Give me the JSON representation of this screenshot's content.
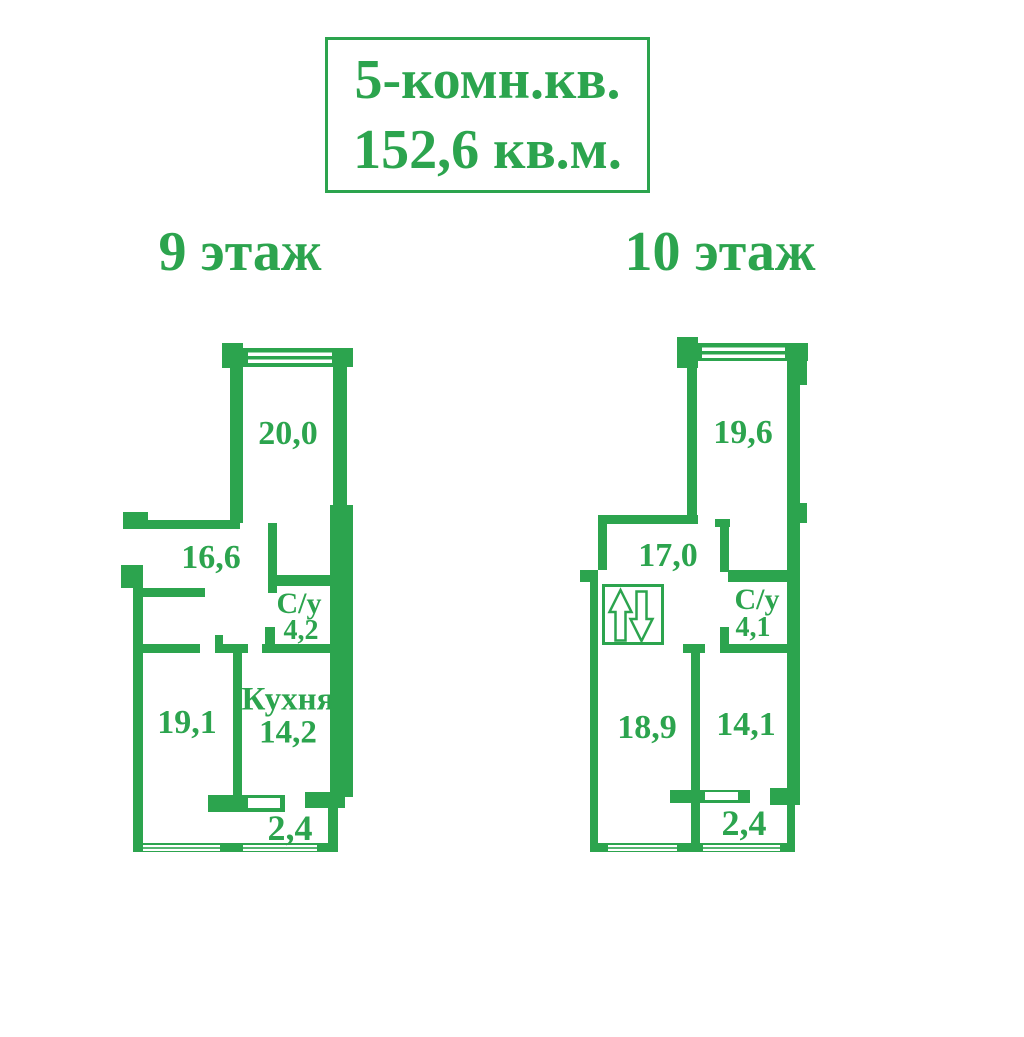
{
  "colors": {
    "green": "#2CA44E",
    "background": "#FFFFFF"
  },
  "title": {
    "line1": "5-комн.кв.",
    "line2": "152,6 кв.м."
  },
  "plans": [
    {
      "floor_label": "9 этаж",
      "rooms": {
        "top_room": {
          "area": "20,0"
        },
        "hall": {
          "area": "16,6"
        },
        "bathroom": {
          "name": "С/у",
          "area": "4,2"
        },
        "left_room": {
          "area": "19,1"
        },
        "kitchen": {
          "name": "Кухня",
          "area": "14,2"
        },
        "balcony": {
          "area": "2,4"
        }
      }
    },
    {
      "floor_label": "10 этаж",
      "icons": {
        "stairs": "up-down-arrows"
      },
      "rooms": {
        "top_room": {
          "area": "19,6"
        },
        "hall": {
          "area": "17,0"
        },
        "bathroom": {
          "name": "С/у",
          "area": "4,1"
        },
        "left_room": {
          "area": "18,9"
        },
        "right_room": {
          "area": "14,1"
        },
        "balcony": {
          "area": "2,4"
        }
      }
    }
  ]
}
